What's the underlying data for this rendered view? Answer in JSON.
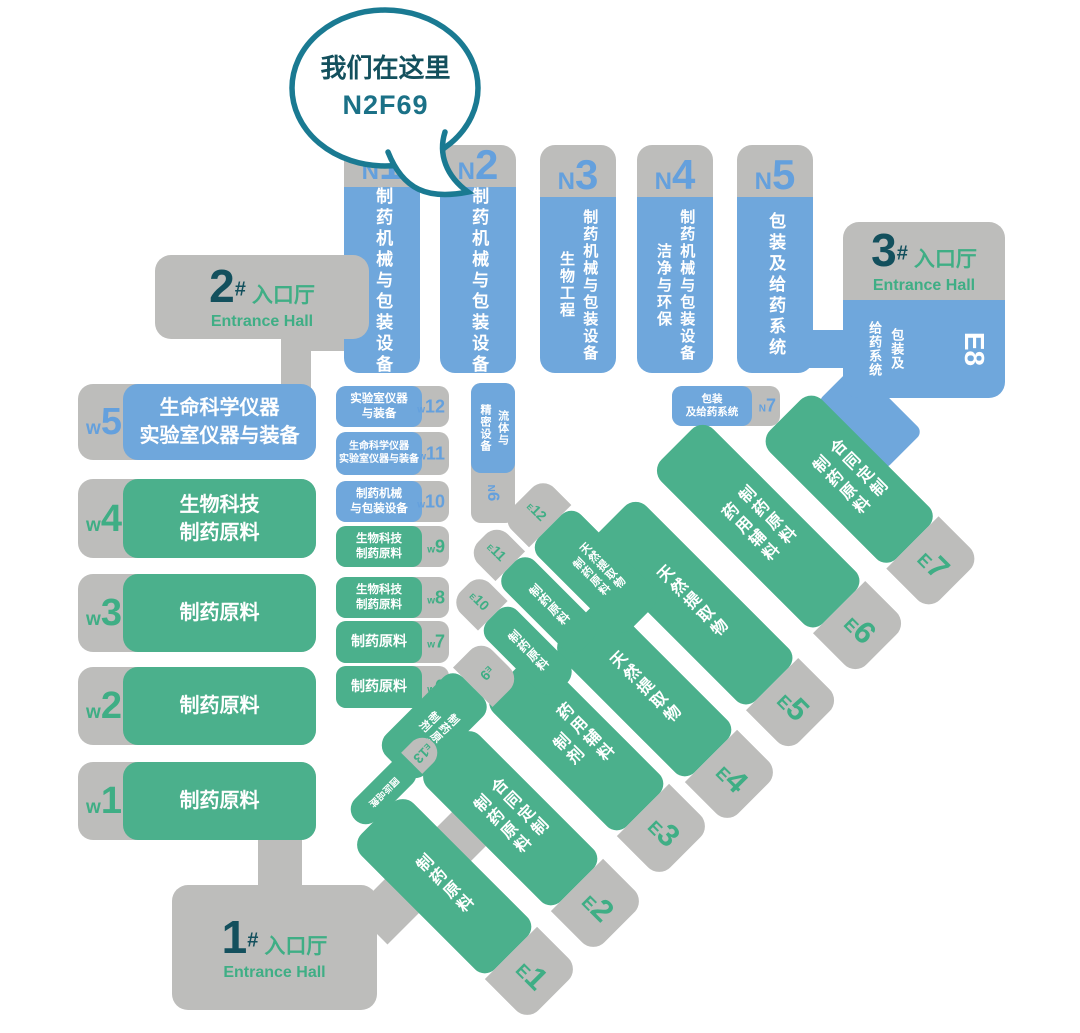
{
  "bubble": {
    "line1": "我们在这里",
    "line2": "N2F69"
  },
  "entrances": [
    {
      "num": "1",
      "hash": "#",
      "cn": "入口厅",
      "en": "Entrance Hall"
    },
    {
      "num": "2",
      "hash": "#",
      "cn": "入口厅",
      "en": "Entrance Hall"
    },
    {
      "num": "3",
      "hash": "#",
      "cn": "入口厅",
      "en": "Entrance Hall"
    }
  ],
  "n_halls": [
    {
      "prefix": "N",
      "num": "1",
      "lines": [
        "制药机械与包装设备"
      ]
    },
    {
      "prefix": "N",
      "num": "2",
      "lines": [
        "制药机械与包装设备"
      ]
    },
    {
      "prefix": "N",
      "num": "3",
      "lines": [
        "制药机械与包装设备",
        "生物工程"
      ]
    },
    {
      "prefix": "N",
      "num": "4",
      "lines": [
        "制药机械与包装设备",
        "洁净与环保"
      ]
    },
    {
      "prefix": "N",
      "num": "5",
      "lines": [
        "包装及给药系统"
      ]
    }
  ],
  "n_small": [
    {
      "prefix": "N",
      "num": "6",
      "lines": [
        "流体与",
        "精密设备"
      ]
    },
    {
      "prefix": "N",
      "num": "7",
      "lines": [
        "包装",
        "及给药系统"
      ]
    }
  ],
  "w_halls": [
    {
      "prefix": "w",
      "num": "5",
      "lines": [
        "生命科学仪器",
        "实验室仪器与装备"
      ]
    },
    {
      "prefix": "w",
      "num": "4",
      "lines": [
        "生物科技",
        "制药原料"
      ]
    },
    {
      "prefix": "w",
      "num": "3",
      "lines": [
        "制药原料"
      ]
    },
    {
      "prefix": "w",
      "num": "2",
      "lines": [
        "制药原料"
      ]
    },
    {
      "prefix": "w",
      "num": "1",
      "lines": [
        "制药原料"
      ]
    }
  ],
  "w_small": [
    {
      "prefix": "w",
      "num": "12",
      "lines": [
        "实验室仪器",
        "与装备"
      ]
    },
    {
      "prefix": "w",
      "num": "11",
      "lines": [
        "生命科学仪器",
        "实验室仪器与装备"
      ]
    },
    {
      "prefix": "w",
      "num": "10",
      "lines": [
        "制药机械",
        "与包装设备"
      ]
    },
    {
      "prefix": "w",
      "num": "9",
      "lines": [
        "生物科技",
        "制药原料"
      ]
    },
    {
      "prefix": "w",
      "num": "8",
      "lines": [
        "生物科技",
        "制药原料"
      ]
    },
    {
      "prefix": "w",
      "num": "7",
      "lines": [
        "制药原料"
      ]
    },
    {
      "prefix": "w",
      "num": "6",
      "lines": [
        "制药原料"
      ]
    }
  ],
  "e_halls": [
    {
      "prefix": "E",
      "num": "1",
      "lines": [
        "制药原料"
      ]
    },
    {
      "prefix": "E",
      "num": "2",
      "lines": [
        "合同定制",
        "制药原料"
      ]
    },
    {
      "prefix": "E",
      "num": "3",
      "lines": [
        "药用辅料",
        "制剂"
      ]
    },
    {
      "prefix": "E",
      "num": "4",
      "lines": [
        "天然提取物"
      ]
    },
    {
      "prefix": "E",
      "num": "5",
      "lines": [
        "天然提取物"
      ]
    },
    {
      "prefix": "E",
      "num": "6",
      "lines": [
        "制药原料",
        "药用辅料"
      ]
    },
    {
      "prefix": "E",
      "num": "7",
      "lines": [
        "合同定制",
        "制药原料"
      ]
    },
    {
      "prefix": "E",
      "num": "8",
      "lines": [
        "包装及",
        "给药系统"
      ]
    }
  ],
  "e_small": [
    {
      "prefix": "E",
      "num": "9",
      "lines": [
        "制药原料",
        "制剂"
      ]
    },
    {
      "prefix": "E",
      "num": "10",
      "lines": [
        "制药原料"
      ]
    },
    {
      "prefix": "E",
      "num": "11",
      "lines": [
        "制药原料"
      ]
    },
    {
      "prefix": "E",
      "num": "12",
      "lines": [
        "天然提取物",
        "制药原料"
      ]
    },
    {
      "prefix": "E",
      "num": "13",
      "lines": [
        "国际品牌"
      ]
    }
  ],
  "colors": {
    "hall_blue": "#6FA7DC",
    "hall_green": "#4BB08C",
    "gray": "#BDBDBB",
    "teal_dark": "#13505D",
    "green_text": "#3FAE85",
    "bubble_stroke": "#1A7A92"
  }
}
